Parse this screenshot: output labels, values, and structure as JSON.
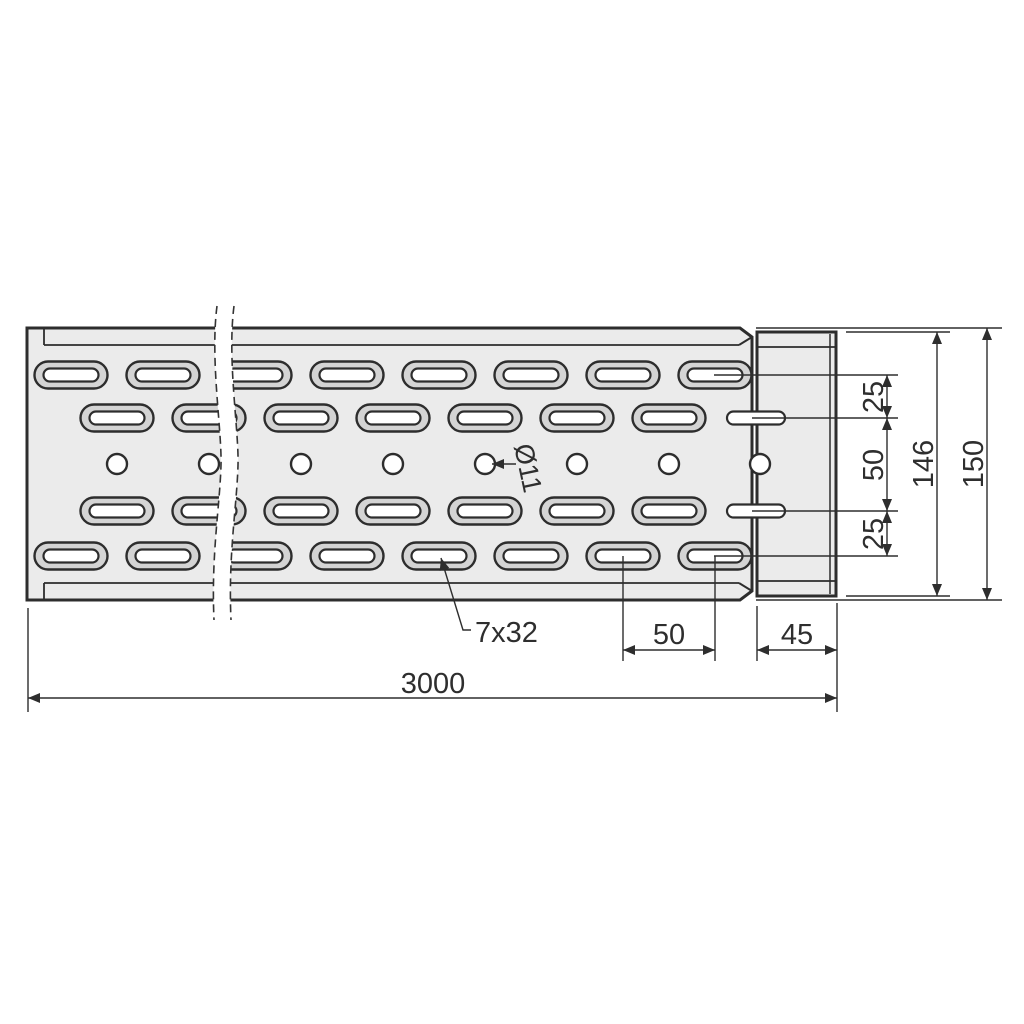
{
  "colors": {
    "background": "#ffffff",
    "part_fill": "#ebebeb",
    "slot_ring_fill": "#d4d4d4",
    "hole_fill": "#ffffff",
    "outline": "#2d2d2d",
    "dimension_line": "#2e2e2e"
  },
  "dimensions": {
    "overall_length": "3000",
    "slot_pitch": "50",
    "connector_width": "45",
    "tab_offset_top": "25",
    "tab_spacing": "50",
    "tab_offset_bottom": "25",
    "connector_height": "146",
    "overall_height": "150"
  },
  "callouts": {
    "hole_diameter": "Ø11",
    "slot_size": "7x32"
  }
}
